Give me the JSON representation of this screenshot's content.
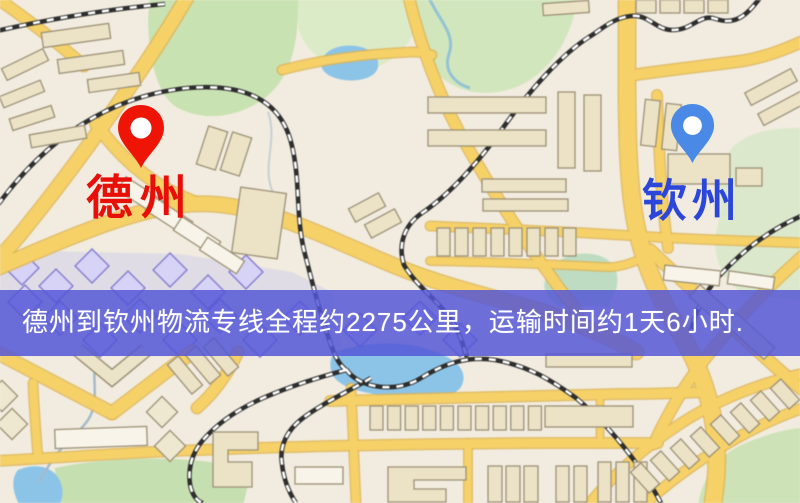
{
  "markers": {
    "origin": {
      "label": "德州",
      "pin_color": "#ee1506",
      "text_color": "#e80f08"
    },
    "destination": {
      "label": "钦州",
      "pin_color": "#4a8ae6",
      "text_color": "#2b46d9"
    }
  },
  "banner": {
    "text": "德州到钦州物流专线全程约2275公里，运输时间约1天6小时.",
    "bg_color": "#5456d5",
    "text_color": "#ffffff"
  },
  "map_palette": {
    "background": "#f1ecdf",
    "road": "#f5d167",
    "road_casing": "#dfb350",
    "water": "#8cc4e8",
    "park": "#cde3b8",
    "building": "#ece3c6",
    "building_outline": "#9c9077",
    "railway": "#2e2e2e",
    "purple_district": "#c9c5ef"
  }
}
